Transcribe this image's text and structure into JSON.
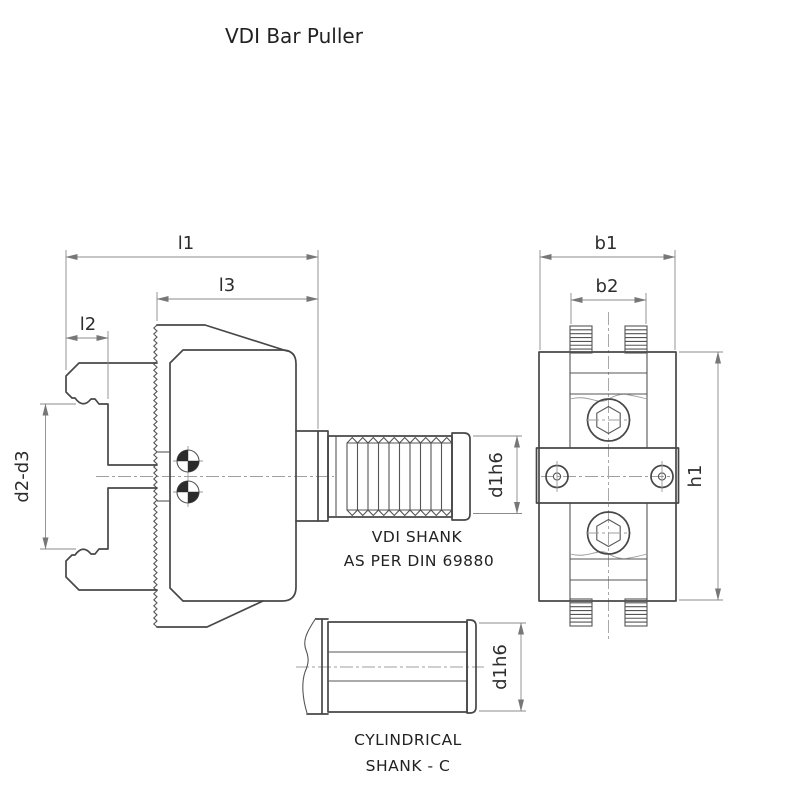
{
  "title": "VDI Bar Puller",
  "colors": {
    "background": "#ffffff",
    "main_line": "#474747",
    "thin_line": "#9a9a9a",
    "text": "#2d2d2d"
  },
  "left_view": {
    "name": "side view with VDI shank",
    "dim_l1": "l1",
    "dim_l3": "l3",
    "dim_l2": "l2",
    "dim_d2_d3": "d2-d3",
    "dim_d1h6": "d1h6",
    "caption_line1": "VDI SHANK",
    "caption_line2": "AS PER DIN 69880"
  },
  "right_view": {
    "name": "front view",
    "dim_b1": "b1",
    "dim_b2": "b2",
    "dim_h1": "h1"
  },
  "cylindrical_view": {
    "name": "cylindrical shank option",
    "dim_d1h6": "d1h6",
    "caption_line1": "CYLINDRICAL",
    "caption_line2": "SHANK - C"
  }
}
